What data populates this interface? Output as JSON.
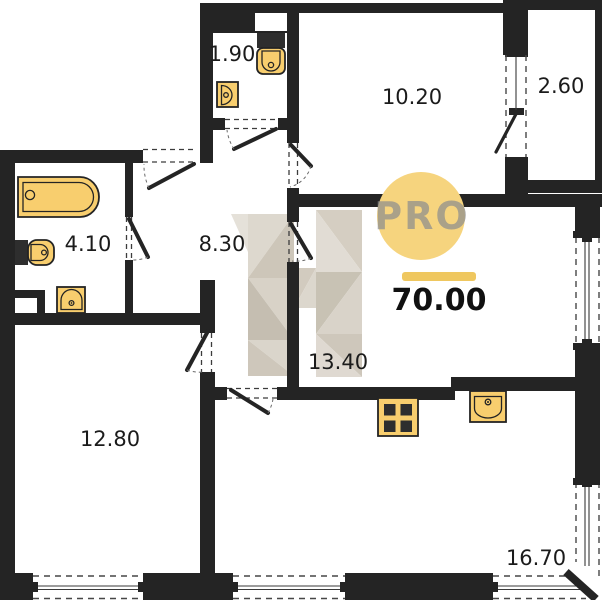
{
  "plan": {
    "logo": {
      "text": "PRO",
      "circle_color": "#F6D47E"
    },
    "total_area": {
      "value": "70.00",
      "accent_color": "#EFC75F"
    },
    "rooms": {
      "wc": {
        "name": "wc",
        "area": "1.90"
      },
      "living": {
        "name": "room-top",
        "area": "10.20"
      },
      "balcony": {
        "name": "balcony",
        "area": "2.60"
      },
      "bathroom": {
        "name": "bathroom",
        "area": "4.10"
      },
      "hallway": {
        "name": "hallway",
        "area": "8.30"
      },
      "bedroom": {
        "name": "room-middle",
        "area": "13.40"
      },
      "bedroom2": {
        "name": "room-left",
        "area": "12.80"
      },
      "kitchen_living": {
        "name": "kitchen-living",
        "area": "16.70"
      }
    },
    "colors": {
      "wall": "#242424",
      "fixture_fill": "#F8CE6E",
      "watermark_light": "#DED9D0",
      "watermark_dark": "#C6BFB1"
    }
  }
}
